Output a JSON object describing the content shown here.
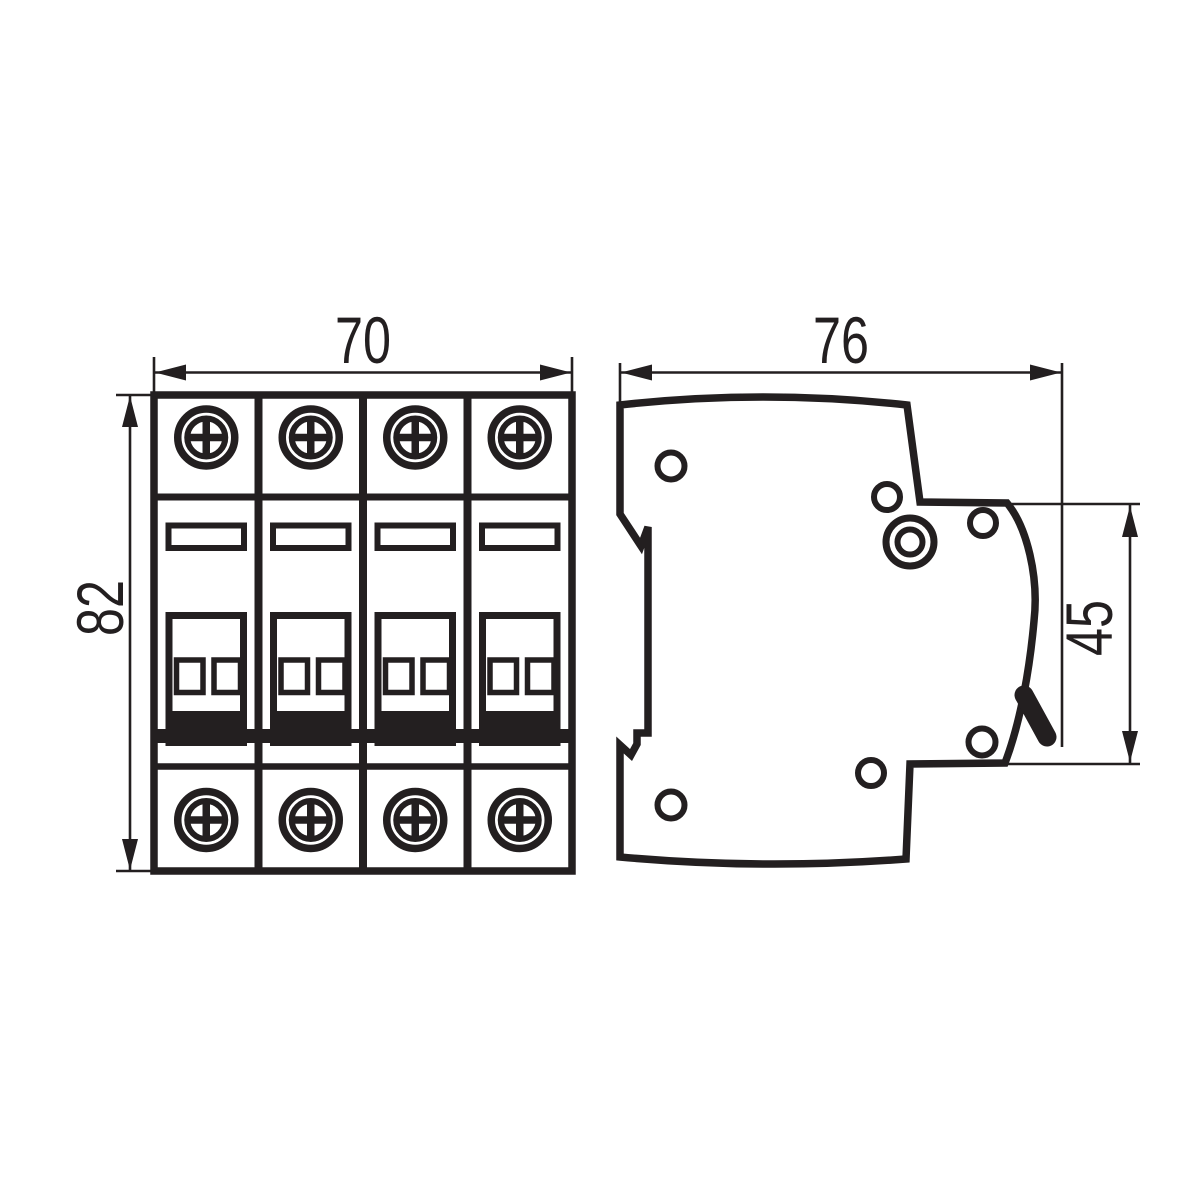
{
  "colors": {
    "line": "#231f20",
    "background": "#ffffff"
  },
  "front_view": {
    "module_count": 4,
    "dimensions": {
      "width": "70",
      "height": "82"
    }
  },
  "side_view": {
    "dimensions": {
      "depth": "76",
      "height": "45"
    }
  }
}
